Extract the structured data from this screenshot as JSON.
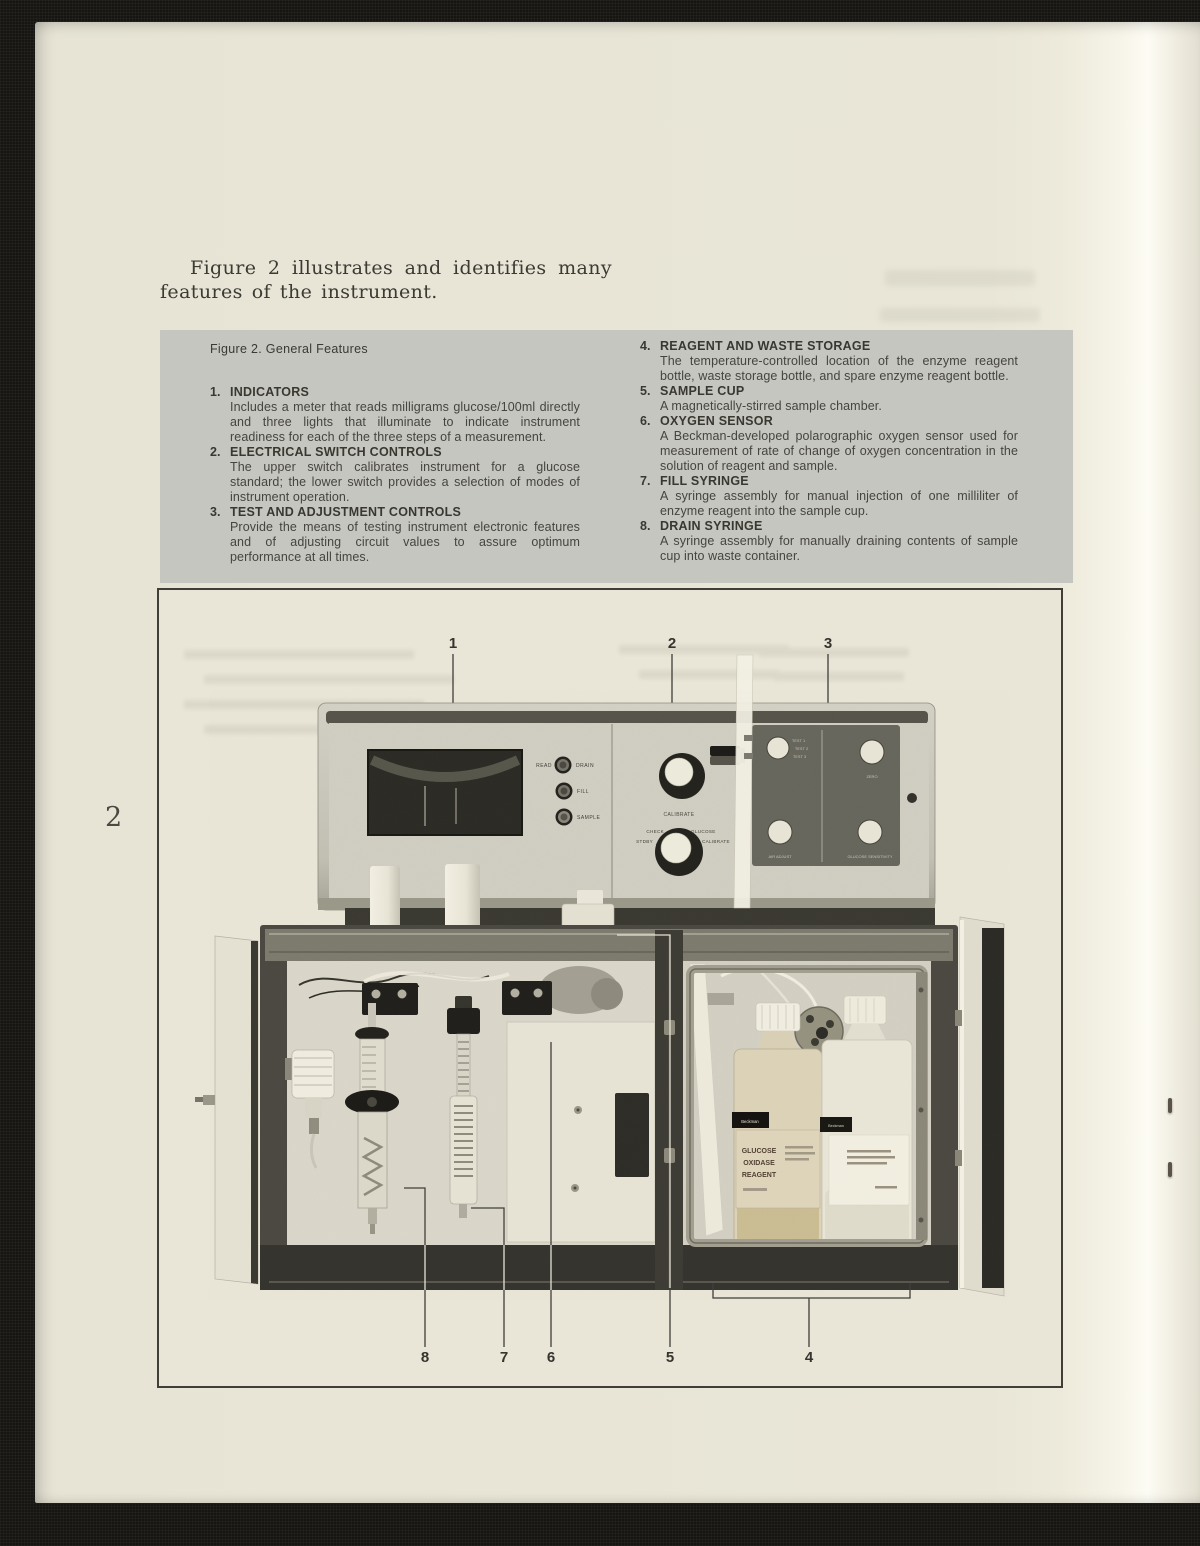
{
  "page": {
    "number": "2",
    "intro": "Figure 2 illustrates and identifies many features of the instrument.",
    "caption": "Figure 2. General Features"
  },
  "features": {
    "left": [
      {
        "num": "1.",
        "title": "INDICATORS",
        "desc": "Includes a meter that reads milligrams glucose/100ml directly and three lights that illuminate to indicate instrument readiness for each of the three steps of a measurement."
      },
      {
        "num": "2.",
        "title": "ELECTRICAL SWITCH CONTROLS",
        "desc": "The upper switch calibrates instrument for a glucose standard; the lower switch provides a selection of modes of instrument operation."
      },
      {
        "num": "3.",
        "title": "TEST AND ADJUSTMENT CONTROLS",
        "desc": "Provide the means of testing instrument electronic features and of adjusting circuit values to assure optimum performance at all times."
      }
    ],
    "right": [
      {
        "num": "4.",
        "title": "REAGENT AND WASTE STORAGE",
        "desc": "The temperature-controlled location of the enzyme reagent bottle, waste storage bottle, and spare enzyme reagent bottle."
      },
      {
        "num": "5.",
        "title": "SAMPLE CUP",
        "desc": "A magnetically-stirred sample chamber."
      },
      {
        "num": "6.",
        "title": "OXYGEN SENSOR",
        "desc": "A Beckman-developed polarographic oxygen sensor used for measurement of rate of change of oxygen concentration in the solution of reagent and sample."
      },
      {
        "num": "7.",
        "title": "FILL SYRINGE",
        "desc": "A syringe assembly for manual injection of one milliliter of enzyme reagent into the sample cup."
      },
      {
        "num": "8.",
        "title": "DRAIN SYRINGE",
        "desc": "A syringe assembly for manually draining contents of sample cup into waste container."
      }
    ]
  },
  "figure": {
    "callouts": [
      "1",
      "2",
      "3",
      "4",
      "5",
      "6",
      "7",
      "8"
    ],
    "panel": {
      "read": "READ",
      "drain": "DRAIN",
      "fill": "FILL",
      "sample": "SAMPLE",
      "calibrate": "CALIBRATE",
      "mode_stdby": "STDBY",
      "mode_check": "CHECK",
      "mode_glucose": "GLUCOSE",
      "mode_calibrate": "CALIBRATE",
      "test1": "TEST 1",
      "test2": "TEST 2",
      "test3": "TEST 3",
      "zero": "ZERO",
      "air_adjust": "AIR ADJUST",
      "glucose_sensitivity": "GLUCOSE SENSITIVITY"
    },
    "bottles": {
      "brand": "Beckman",
      "label_line1": "GLUCOSE",
      "label_line2": "OXIDASE",
      "label_line3": "REAGENT"
    }
  },
  "colors": {
    "paper": "#e9e6d7",
    "features_box": "#c6c6c1",
    "ink": "#3c3b35",
    "photo_dark_panel": "#67665c"
  }
}
